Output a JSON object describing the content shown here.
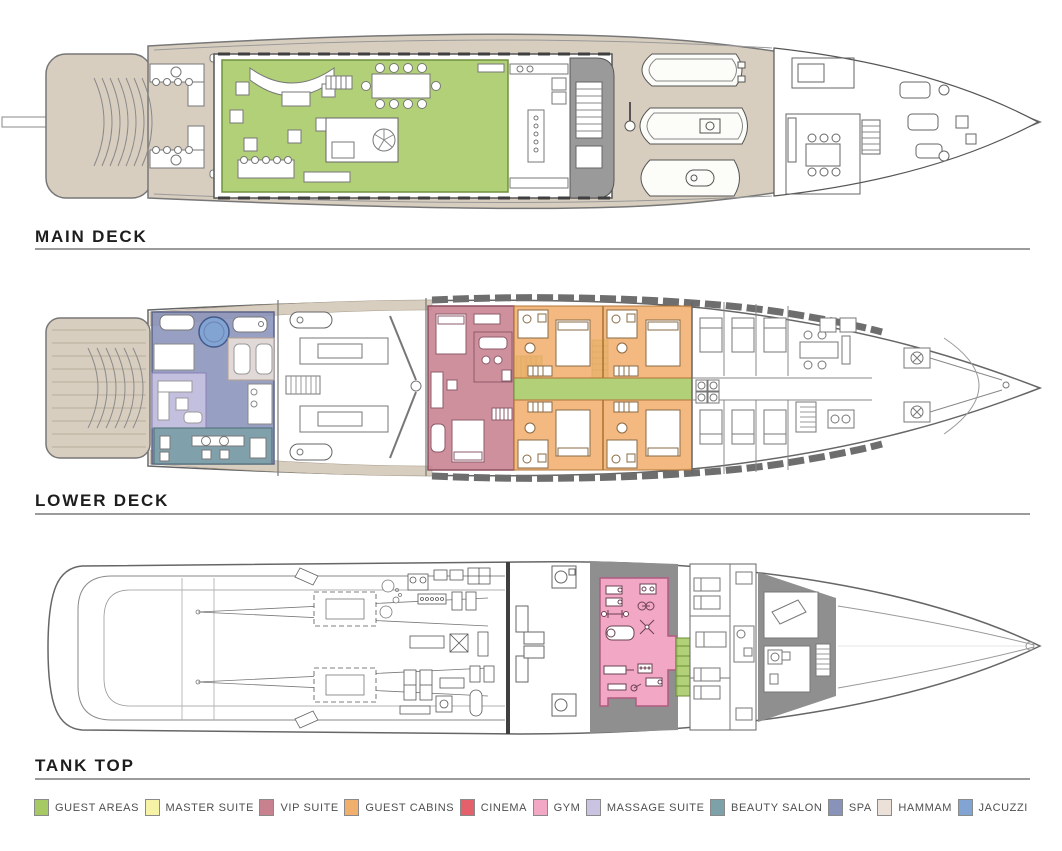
{
  "decks": [
    {
      "id": "main-deck",
      "label": "MAIN DECK"
    },
    {
      "id": "lower-deck",
      "label": "LOWER DECK"
    },
    {
      "id": "tank-top",
      "label": "TANK TOP"
    }
  ],
  "legend": {
    "items": [
      {
        "label": "GUEST AREAS",
        "color": "#a7c964"
      },
      {
        "label": "MASTER SUITE",
        "color": "#f6f2a6"
      },
      {
        "label": "VIP SUITE",
        "color": "#c8818f"
      },
      {
        "label": "GUEST CABINS",
        "color": "#f1af6e"
      },
      {
        "label": "CINEMA",
        "color": "#e4606a"
      },
      {
        "label": "GYM",
        "color": "#f2a8c4"
      },
      {
        "label": "MASSAGE SUITE",
        "color": "#cac4e2"
      },
      {
        "label": "BEAUTY SALON",
        "color": "#7da1a9"
      },
      {
        "label": "SPA",
        "color": "#8992b9"
      },
      {
        "label": "HAMMAM",
        "color": "#ece1d9"
      },
      {
        "label": "JACUZZI",
        "color": "#81a4d2"
      }
    ]
  },
  "colors": {
    "deck_teak": "#d8cec0",
    "structure_gray": "#9a9a9a",
    "void_gray": "#8f8f8f"
  }
}
